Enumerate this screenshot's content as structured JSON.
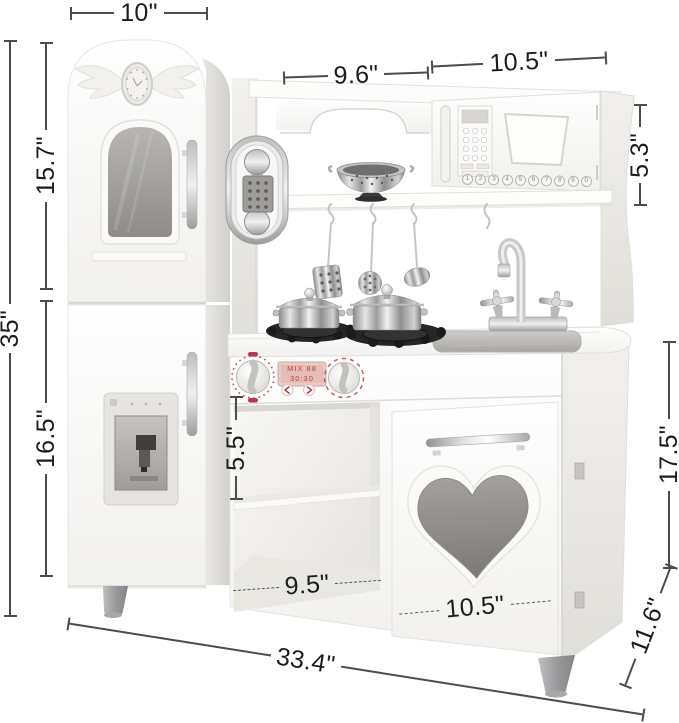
{
  "diagram": {
    "subject": "kids play kitchen with dimension annotations"
  },
  "dimensions": {
    "fridge_top_width": "10\"",
    "hutch_left_width": "9.6\"",
    "hutch_right_width": "10.5\"",
    "upper_section_height": "15.7\"",
    "total_height": "35\"",
    "lower_section_height": "16.5\"",
    "hutch_height": "5.3\"",
    "shelf_opening_height": "5.5\"",
    "shelf_opening_width": "9.5\"",
    "door_width": "10.5\"",
    "right_cabinet_height": "17.5\"",
    "depth": "11.6\"",
    "overall_width": "33.4\""
  },
  "microwave": {
    "digits": [
      "1",
      "2",
      "3",
      "4",
      "5",
      "6",
      "7",
      "8",
      "9",
      "0"
    ]
  },
  "stove": {
    "lcd": [
      "MIX 88",
      "30:30"
    ]
  },
  "colors": {
    "background": "#ffffff",
    "dimension_line": "#4c4c4c",
    "label_text": "#1c1c1c",
    "accent_red": "#b23a52",
    "glass_gray": "#a09e9b",
    "heart_gray": "#8f8d8a",
    "metal_silver": "#c9c9c9",
    "burner_black": "#222222"
  }
}
